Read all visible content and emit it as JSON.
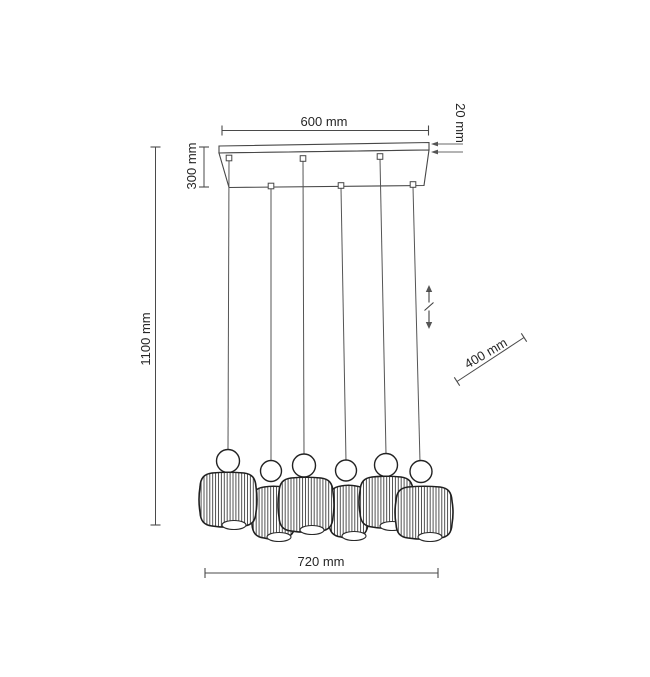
{
  "diagram": {
    "subject": "6-light linear pendant lamp, technical dimension drawing",
    "lamp_count": 6,
    "dimensions": {
      "canopy_width": "600 mm",
      "canopy_thickness": "20 mm",
      "canopy_drop": "300 mm",
      "total_height": "1100 mm",
      "adjustment_range": "400 mm",
      "fixture_width": "720 mm"
    },
    "colors": {
      "background": "#ffffff",
      "dimension_line": "#4a4a4a",
      "drawing_outline": "#1f1f1f",
      "text": "#262626"
    }
  }
}
